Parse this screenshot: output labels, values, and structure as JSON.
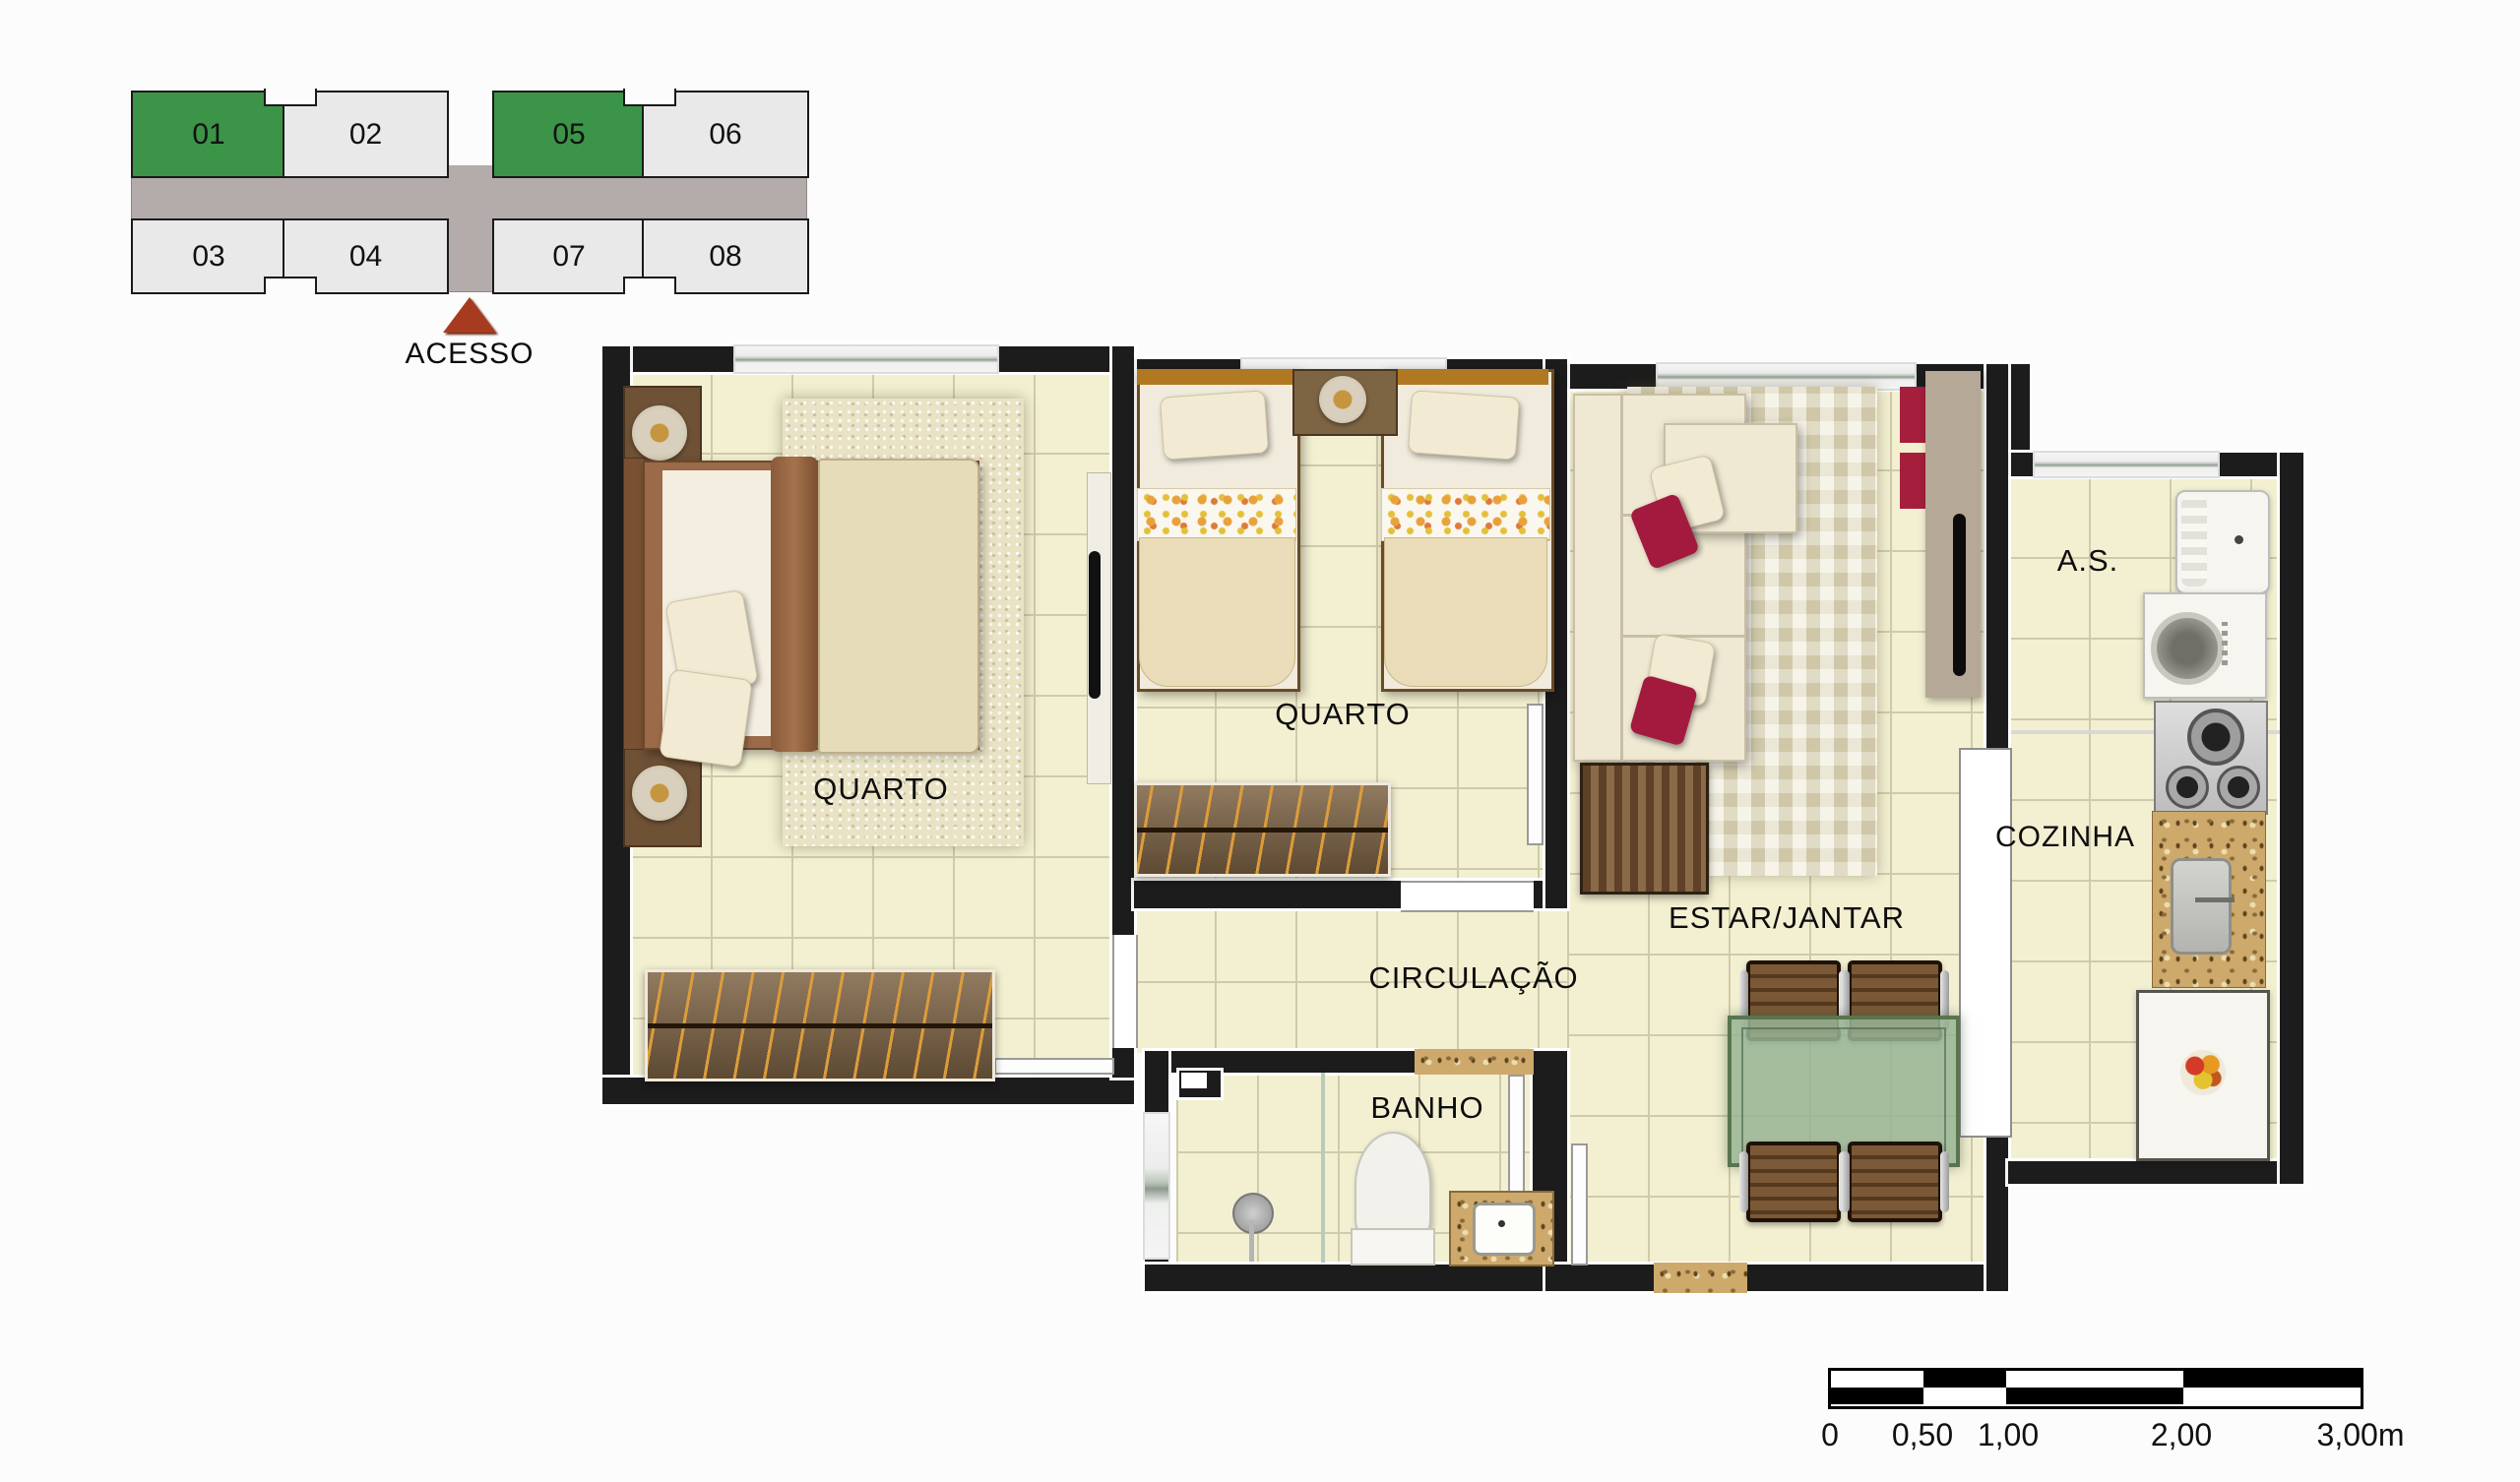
{
  "key_plan": {
    "units": [
      {
        "label": "01",
        "highlighted": true
      },
      {
        "label": "02",
        "highlighted": false
      },
      {
        "label": "05",
        "highlighted": true
      },
      {
        "label": "06",
        "highlighted": false
      },
      {
        "label": "03",
        "highlighted": false
      },
      {
        "label": "04",
        "highlighted": false
      },
      {
        "label": "07",
        "highlighted": false
      },
      {
        "label": "08",
        "highlighted": false
      }
    ],
    "access_label": "ACESSO",
    "highlight_color": "#3b9447",
    "unit_color": "#e9e9e9",
    "corridor_color": "#b4abab",
    "access_arrow_color": "#a63b20"
  },
  "floor_plan": {
    "rooms": [
      {
        "name": "quarto-1",
        "label": "QUARTO"
      },
      {
        "name": "quarto-2",
        "label": "QUARTO"
      },
      {
        "name": "circulacao",
        "label": "CIRCULAÇÃO"
      },
      {
        "name": "banho",
        "label": "BANHO"
      },
      {
        "name": "estar-jantar",
        "label": "ESTAR/JANTAR"
      },
      {
        "name": "cozinha",
        "label": "COZINHA"
      },
      {
        "name": "area-servico",
        "label": "A.S."
      }
    ],
    "wall_color": "#1c1c1c",
    "floor_color": "#f3f0d2",
    "accent_red": "#a31a3e",
    "table_green": "#9fbd9b",
    "granite": "#cda96b"
  },
  "scale_bar": {
    "labels": [
      "0",
      "0,50",
      "1,00",
      "2,00",
      "3,00m"
    ]
  }
}
